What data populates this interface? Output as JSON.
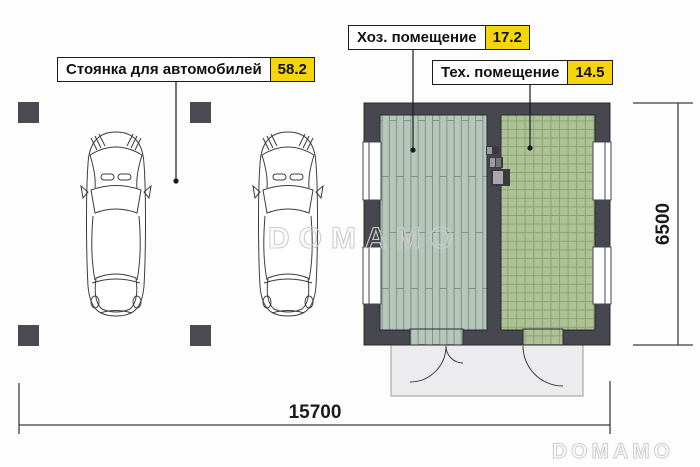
{
  "labels": {
    "parking": {
      "text": "Стоянка для автомобилей",
      "area": "58.2"
    },
    "utility": {
      "text": "Хоз. помещение",
      "area": "17.2"
    },
    "tech": {
      "text": "Тех. помещение",
      "area": "14.5"
    }
  },
  "dimensions": {
    "width_mm": "15700",
    "height_mm": "6500"
  },
  "watermark": {
    "text": "DOMAMO"
  },
  "colors": {
    "wall": "#47474f",
    "area_highlight": "#f6d60a",
    "plank_floor": "#b5c7bb",
    "tile_floor": "#adc295",
    "porch": "#ececee"
  }
}
